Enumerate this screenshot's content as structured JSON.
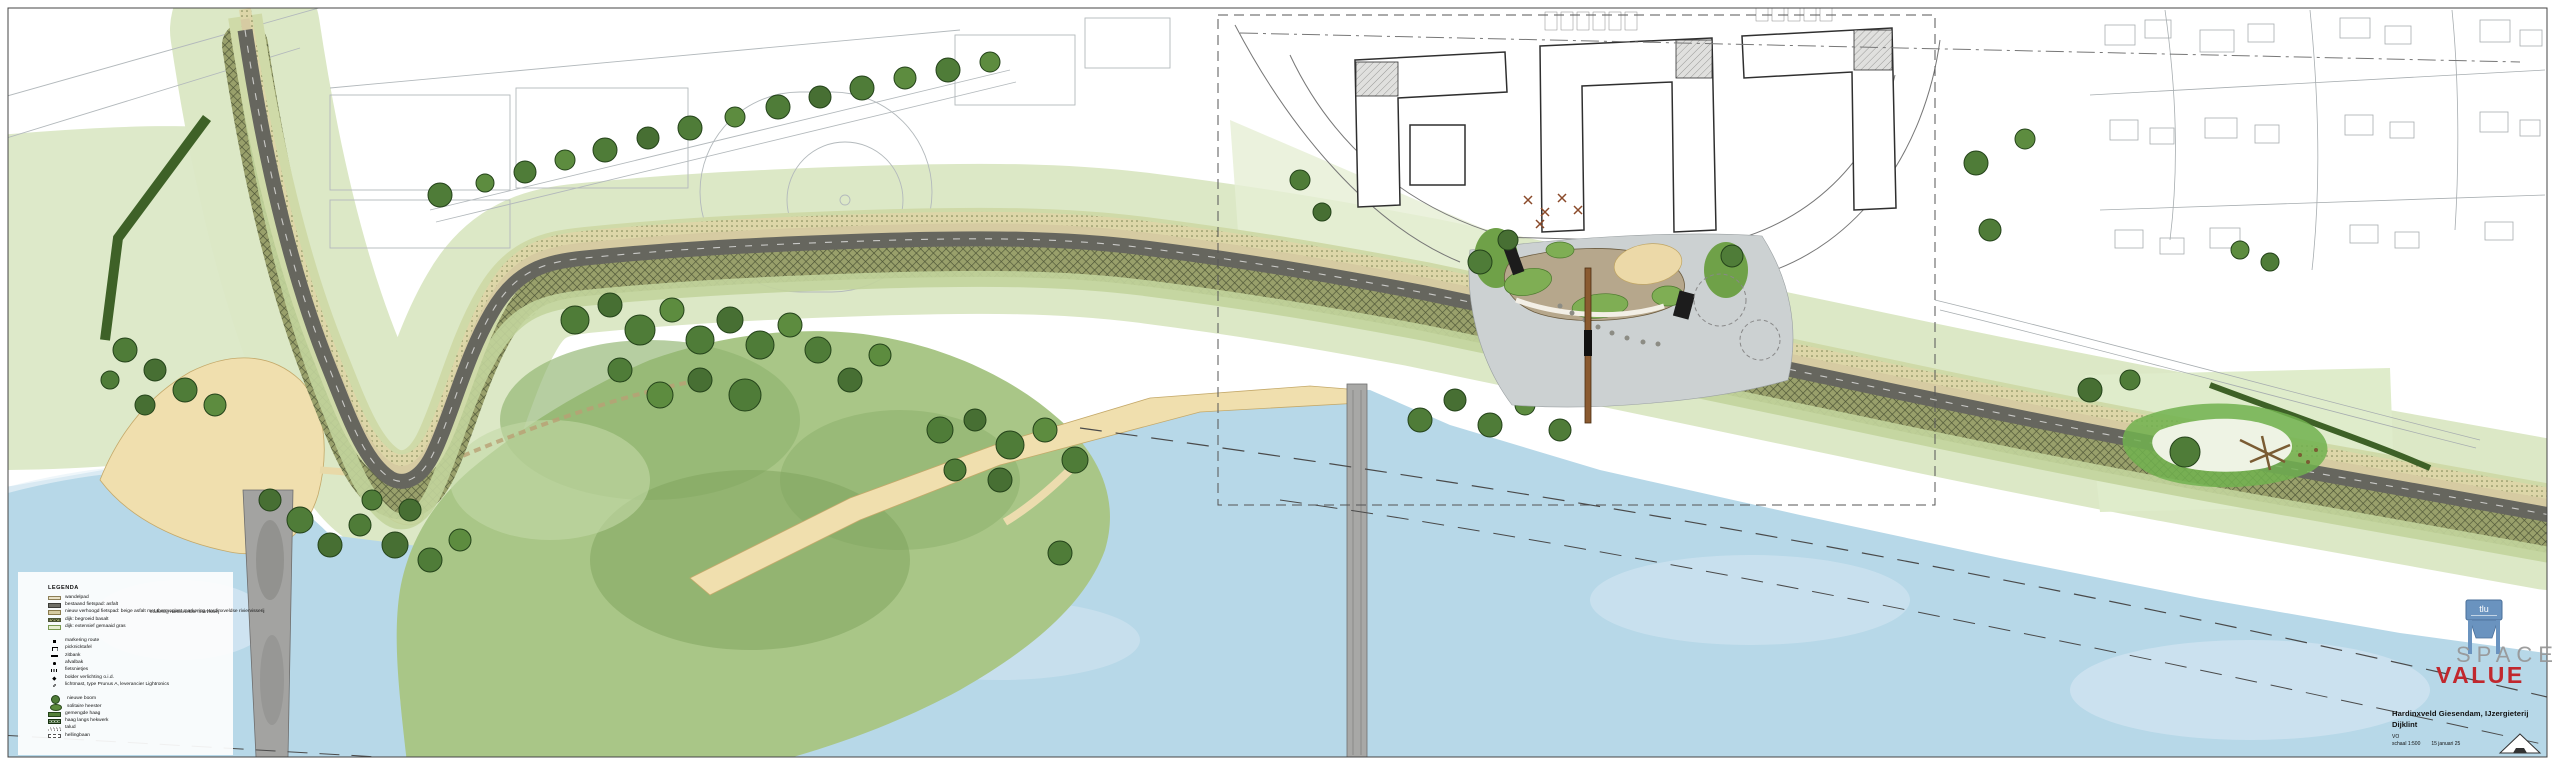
{
  "legend": {
    "title": "LEGENDA",
    "items": [
      {
        "label": "wandelpad"
      },
      {
        "label": "bestaand fietspad: asfalt"
      },
      {
        "label": "nieuw verhoogd fietspad: beige asfalt met thermoplast markering Hardinxveldse riviervisserij"
      },
      {
        "label": "dijk: begroeid basalt"
      },
      {
        "label": "dijk: extensief gemaaid gras"
      },
      {
        "label": "markering route"
      },
      {
        "label": "picknicktafel"
      },
      {
        "label": "zitbank"
      },
      {
        "label": "afvalbak"
      },
      {
        "label": "fietsnietjes"
      },
      {
        "label": "bolder verlichting o.i.d."
      },
      {
        "label": "lichtmast, type Prunus A, leverancier Lightronics"
      },
      {
        "label": "nieuwe boom"
      },
      {
        "label": "solitaire heester"
      },
      {
        "label": "gemengde haag"
      },
      {
        "label": "haag langs hekwerk"
      },
      {
        "label": "talud"
      },
      {
        "label": "hellingbaan"
      }
    ]
  },
  "title_block": {
    "project": "Hardinxveld Giesendam, IJzergieterij",
    "subtitle": "Dijklint",
    "phase": "VO",
    "scale": "schaal 1:500",
    "date": "15 januari 25"
  },
  "logo": {
    "line1": "SPACE",
    "line2": "VALUE"
  },
  "map": {
    "annotation_road_marking": "markering Hardinxveldse riviervisserij",
    "landmark_label": "tlu"
  },
  "colors": {
    "water": "#b7d8e8",
    "park_green": "#a9c687",
    "tree_green": "#4f7c38",
    "sand": "#f0dfae",
    "asphalt": "#66665e",
    "new_path_beige": "#d6cba2",
    "logo_red": "#c1272d",
    "logo_gray": "#9b9b9b"
  }
}
